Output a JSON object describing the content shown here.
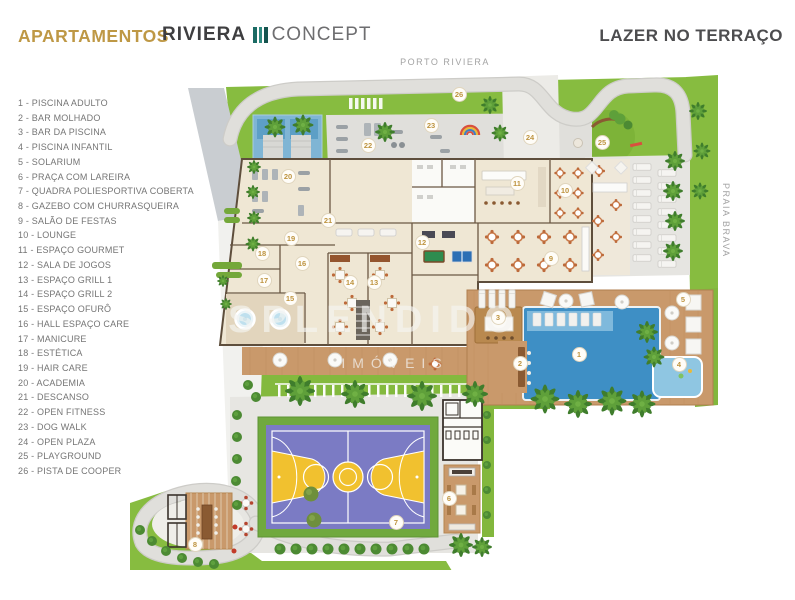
{
  "header": {
    "apartamentos": "APARTAMENTOS",
    "brand_name": "RIVIERA",
    "brand_suffix": "CONCEPT",
    "page_title": "LAZER NO TERRAÇO"
  },
  "plan_labels": {
    "top": "PORTO RIVIERA",
    "right": "PRAIA BRAVA"
  },
  "watermark": {
    "line1": "SPLENDIDO",
    "line2": "IMÓVEIS"
  },
  "legend": {
    "items": [
      "1 - PISCINA ADULTO",
      "2 - BAR MOLHADO",
      "3 - BAR DA PISCINA",
      "4 - PISCINA INFANTIL",
      "5 - SOLARIUM",
      "6 - PRAÇA COM LAREIRA",
      "7 - QUADRA POLIESPORTIVA COBERTA",
      "8 - GAZEBO COM CHURRASQUEIRA",
      "9 - SALÃO DE FESTAS",
      "10 - LOUNGE",
      "11 - ESPAÇO GOURMET",
      "12 - SALA DE JOGOS",
      "13 - ESPAÇO GRILL 1",
      "14 - ESPAÇO GRILL 2",
      "15 - ESPAÇO OFURÔ",
      "16 - HALL ESPAÇO CARE",
      "17 - MANICURE",
      "18 - ESTÉTICA",
      "19 - HAIR CARE",
      "20 - ACADEMIA",
      "21 - DESCANSO",
      "22 - OPEN FITNESS",
      "23 - DOG WALK",
      "24 - OPEN PLAZA",
      "25 - PLAYGROUND",
      "26 - PISTA DE COOPER"
    ]
  },
  "plan": {
    "markers": [
      {
        "n": "1",
        "x": 449,
        "y": 279
      },
      {
        "n": "2",
        "x": 390,
        "y": 288
      },
      {
        "n": "3",
        "x": 368,
        "y": 242
      },
      {
        "n": "4",
        "x": 549,
        "y": 289
      },
      {
        "n": "5",
        "x": 553,
        "y": 224
      },
      {
        "n": "6",
        "x": 319,
        "y": 423
      },
      {
        "n": "7",
        "x": 266,
        "y": 447
      },
      {
        "n": "8",
        "x": 65,
        "y": 469
      },
      {
        "n": "9",
        "x": 421,
        "y": 183
      },
      {
        "n": "10",
        "x": 435,
        "y": 115
      },
      {
        "n": "11",
        "x": 387,
        "y": 108
      },
      {
        "n": "12",
        "x": 292,
        "y": 167
      },
      {
        "n": "13",
        "x": 244,
        "y": 207
      },
      {
        "n": "14",
        "x": 220,
        "y": 207
      },
      {
        "n": "15",
        "x": 160,
        "y": 223
      },
      {
        "n": "16",
        "x": 172,
        "y": 188
      },
      {
        "n": "17",
        "x": 134,
        "y": 205
      },
      {
        "n": "18",
        "x": 132,
        "y": 178
      },
      {
        "n": "19",
        "x": 161,
        "y": 163
      },
      {
        "n": "20",
        "x": 158,
        "y": 101
      },
      {
        "n": "21",
        "x": 198,
        "y": 145
      },
      {
        "n": "22",
        "x": 238,
        "y": 70
      },
      {
        "n": "23",
        "x": 301,
        "y": 50
      },
      {
        "n": "24",
        "x": 400,
        "y": 62
      },
      {
        "n": "25",
        "x": 472,
        "y": 67
      },
      {
        "n": "26",
        "x": 329,
        "y": 19
      }
    ]
  },
  "colors": {
    "accent_gold": "#BE9845",
    "logo_teal": "#1C6B64",
    "title_gray": "#4D4D4F",
    "grass": "#87BC40",
    "road": "#DFDEDA",
    "pool_blue": "#3E8FC5",
    "kids_pool": "#8FC6E2",
    "deck_wood": "#C9996B",
    "building_floor": "#EFE7D4",
    "court_purple": "#7B7BC4",
    "court_yellow": "#F1C12F",
    "marker_text": "#BE9440"
  }
}
